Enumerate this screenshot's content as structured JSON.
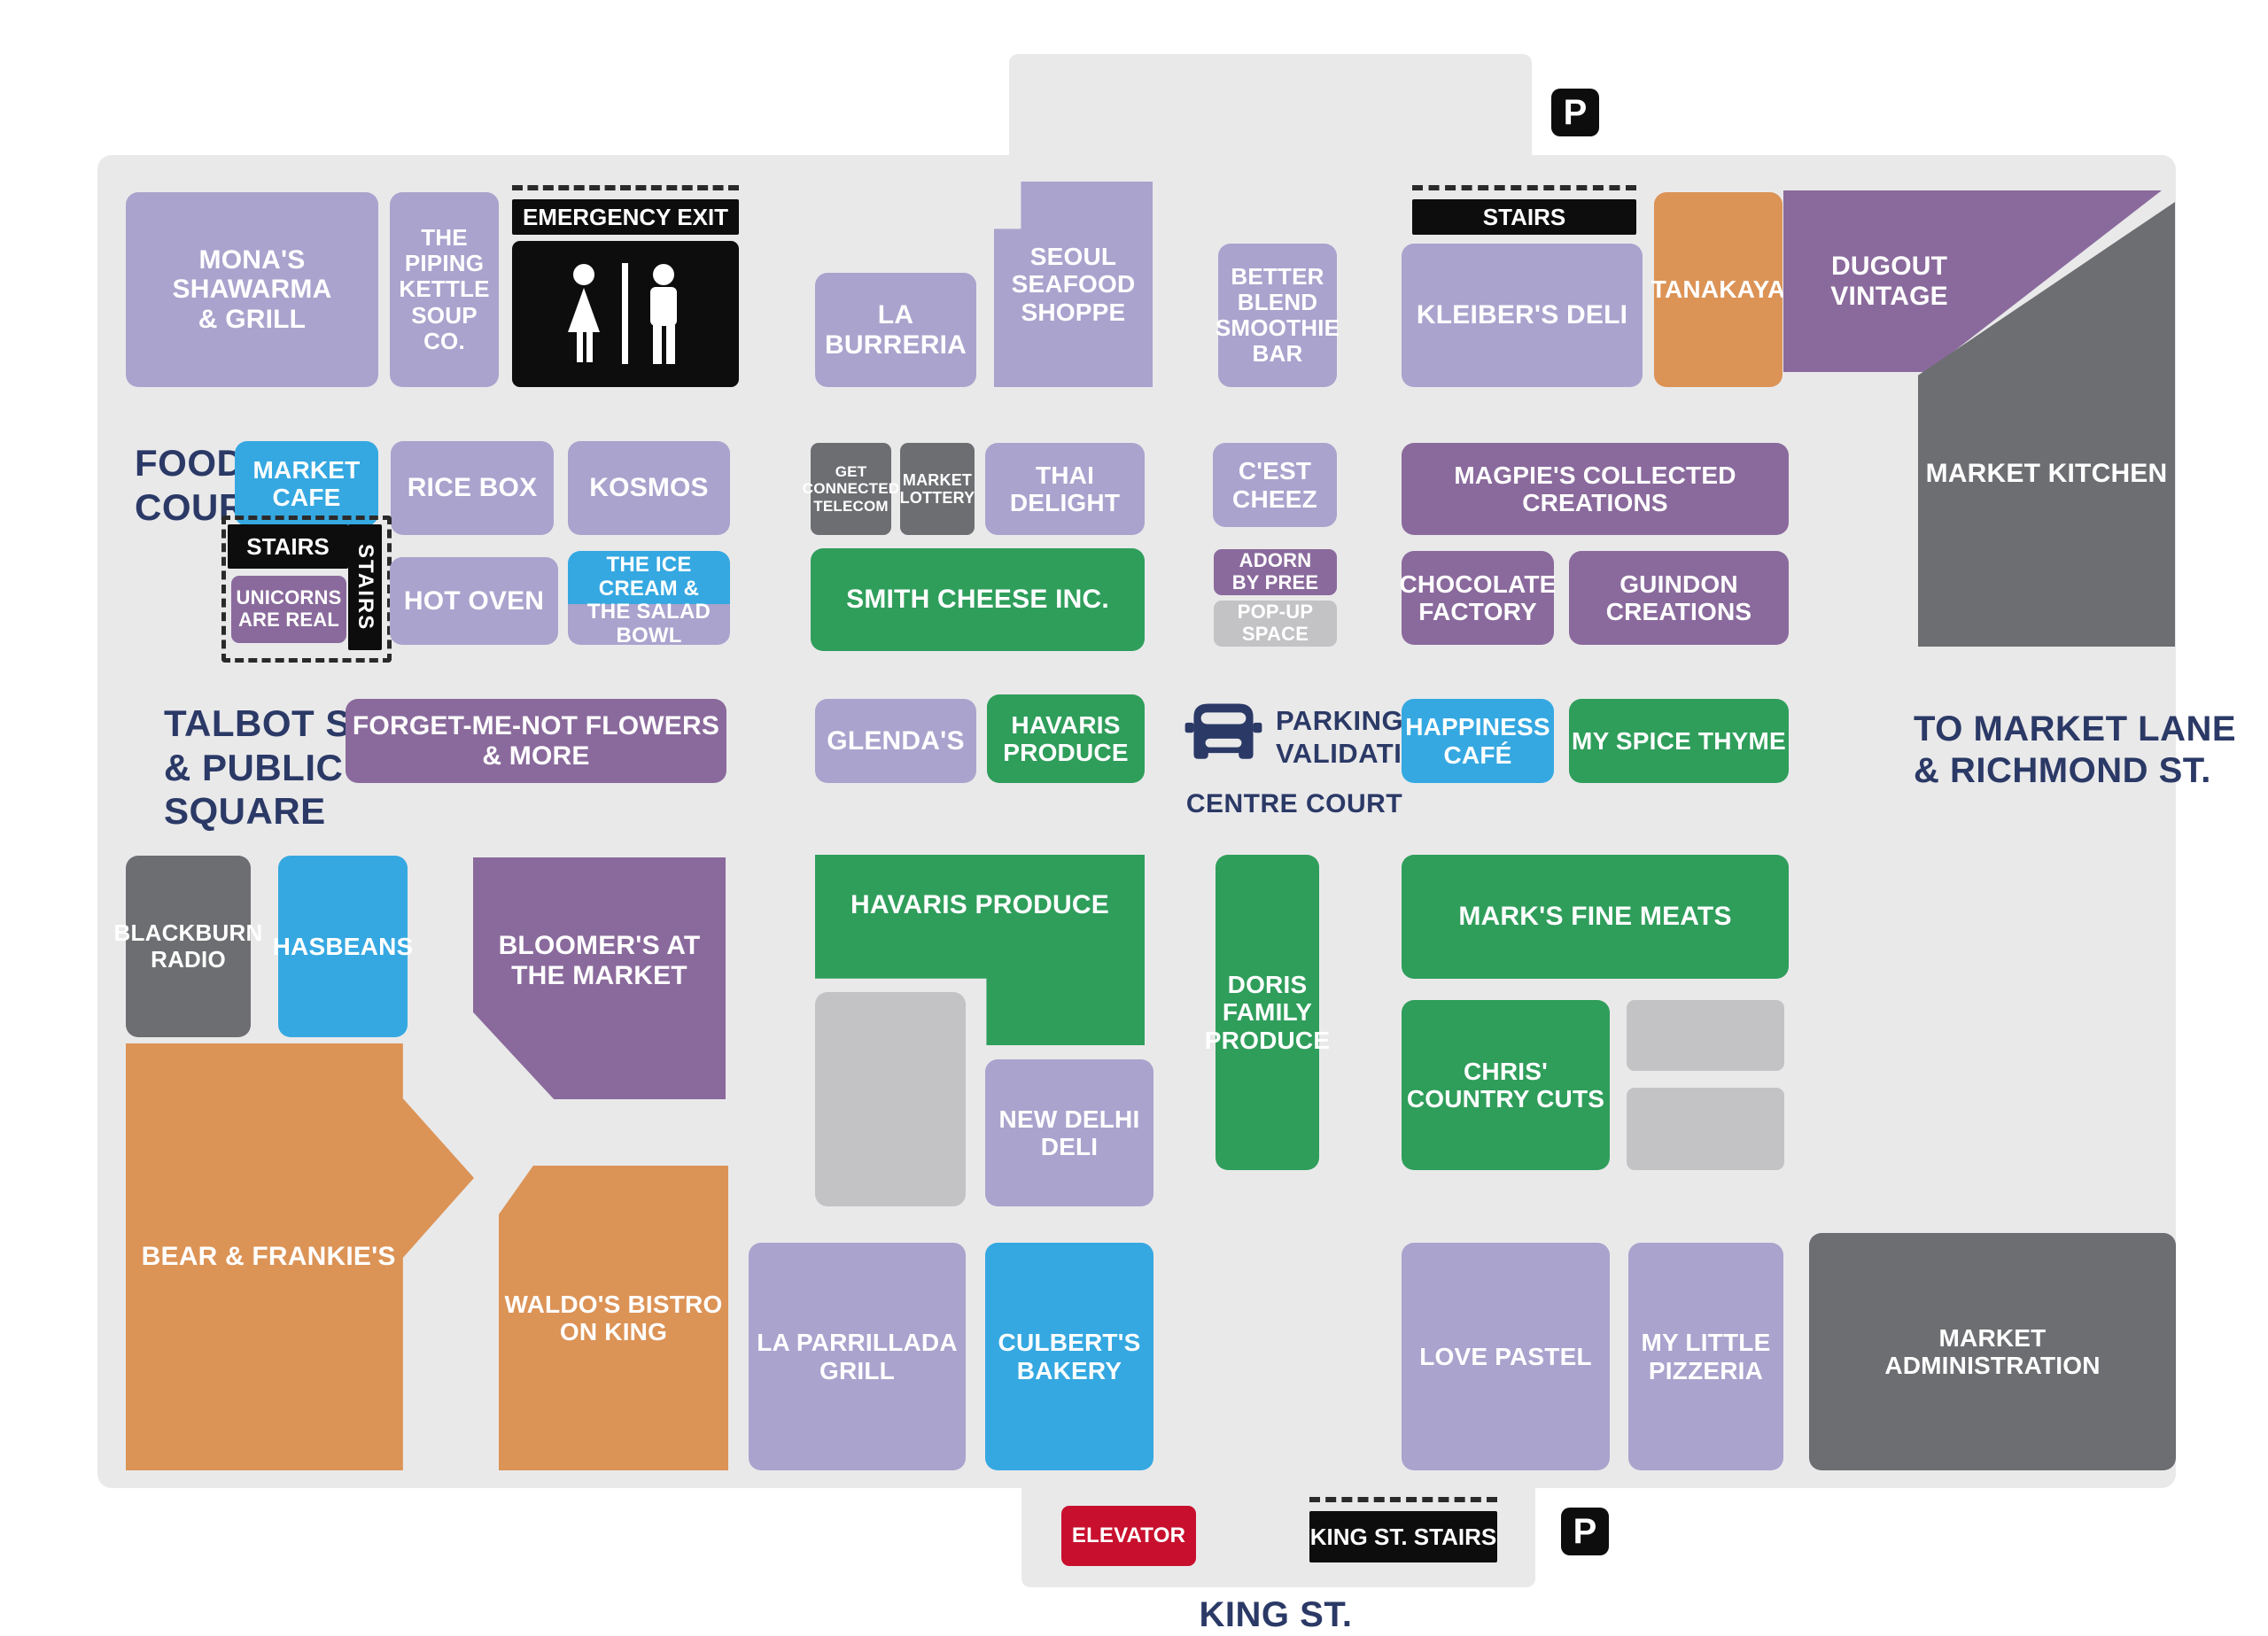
{
  "title": "Market floor plan",
  "palette": {
    "map_background": "#e9e9ea",
    "page_background": "#ffffff",
    "store_lavender": "#a9a3cd",
    "store_blue": "#35a8e1",
    "store_green": "#2f9e5b",
    "store_purple": "#8a6a9c",
    "store_orange": "#dc9356",
    "store_darkgray": "#6d6e71",
    "store_lightgray": "#c3c3c5",
    "banner_black": "#0d0d0d",
    "elevator_red": "#c8102e",
    "label_navy": "#2b3966"
  },
  "area_labels": {
    "food_court": "FOOD\nCOURT",
    "talbot": "TALBOT ST.\n& PUBLIC\nSQUARE",
    "to_market_lane": "TO MARKET LANE\n& RICHMOND ST.",
    "centre_court": "CENTRE COURT",
    "king_st": "KING ST."
  },
  "nav": {
    "emergency_exit": "EMERGENCY EXIT",
    "stairs_top_right": "STAIRS",
    "stairs_food_court_h": "STAIRS",
    "stairs_food_court_v": "STAIRS",
    "king_st_stairs": "KING ST. STAIRS",
    "elevator": "ELEVATOR",
    "parking_letter_top": "P",
    "parking_letter_bottom": "P",
    "parking_validation": "PARKING\nVALIDATION"
  },
  "stores": {
    "monas": {
      "label": "MONA'S SHAWARMA\n& GRILL",
      "color": "lavender"
    },
    "piping": {
      "label": "THE\nPIPING\nKETTLE\nSOUP CO.",
      "color": "lavender"
    },
    "laburreria": {
      "label": "LA BURRERIA",
      "color": "lavender"
    },
    "seoul": {
      "label": "SEOUL\nSEAFOOD\nSHOPPE",
      "color": "lavender"
    },
    "betterblend": {
      "label": "BETTER\nBLEND\nSMOOTHIE\nBAR",
      "color": "lavender"
    },
    "kleibers": {
      "label": "KLEIBER'S DELI",
      "color": "lavender"
    },
    "tanakaya": {
      "label": "TANAKAYA",
      "color": "orange"
    },
    "dugout": {
      "label": "DUGOUT\nVINTAGE",
      "color": "purple"
    },
    "market_kitchen": {
      "label": "MARKET KITCHEN",
      "color": "darkgray"
    },
    "market_cafe": {
      "label": "MARKET\nCAFE",
      "color": "blue"
    },
    "ricebox": {
      "label": "RICE BOX",
      "color": "lavender"
    },
    "kosmos": {
      "label": "KOSMOS",
      "color": "lavender"
    },
    "get_connected": {
      "label": "GET\nCONNECTED\nTELECOM",
      "color": "darkgray"
    },
    "market_lottery": {
      "label": "MARKET\nLOTTERY",
      "color": "darkgray"
    },
    "thai_delight": {
      "label": "THAI DELIGHT",
      "color": "lavender"
    },
    "cest_cheez": {
      "label": "C'EST\nCHEEZ",
      "color": "lavender"
    },
    "magpies": {
      "label": "MAGPIE'S COLLECTED\nCREATIONS",
      "color": "purple"
    },
    "smith_cheese": {
      "label": "SMITH CHEESE INC.",
      "color": "green"
    },
    "adorn": {
      "label": "ADORN\nBY PREE",
      "color": "purple"
    },
    "popup": {
      "label": "POP-UP\nSPACE",
      "color": "lightgray"
    },
    "unicorns": {
      "label": "UNICORNS\nARE REAL",
      "color": "purple"
    },
    "hot_oven": {
      "label": "HOT OVEN",
      "color": "lavender"
    },
    "ice_cream": {
      "label": "THE ICE\nCREAM &",
      "color": "blue"
    },
    "salad_bowl": {
      "label": "THE SALAD BOWL",
      "color": "lavender"
    },
    "chocolate": {
      "label": "CHOCOLATE\nFACTORY",
      "color": "purple"
    },
    "guindon": {
      "label": "GUINDON\nCREATIONS",
      "color": "purple"
    },
    "forgetmenot": {
      "label": "FORGET-ME-NOT FLOWERS & MORE",
      "color": "purple"
    },
    "glendas": {
      "label": "GLENDA'S",
      "color": "lavender"
    },
    "havaris_small": {
      "label": "HAVARIS\nPRODUCE",
      "color": "green"
    },
    "happiness": {
      "label": "HAPPINESS\nCAFÉ",
      "color": "blue"
    },
    "myspice": {
      "label": "MY SPICE THYME",
      "color": "green"
    },
    "blackburn": {
      "label": "BLACKBURN\nRADIO",
      "color": "darkgray"
    },
    "hasbeans": {
      "label": "HASBEANS",
      "color": "blue"
    },
    "bloomers": {
      "label": "BLOOMER'S AT\nTHE MARKET",
      "color": "purple"
    },
    "havaris_big": {
      "label": "HAVARIS PRODUCE",
      "color": "green"
    },
    "vacant_1": {
      "label": "",
      "color": "lightgray"
    },
    "new_delhi": {
      "label": "NEW DELHI\nDELI",
      "color": "lavender"
    },
    "doris": {
      "label": "DORIS\nFAMILY\nPRODUCE",
      "color": "green"
    },
    "marks": {
      "label": "MARK'S FINE MEATS",
      "color": "green"
    },
    "chris": {
      "label": "CHRIS'\nCOUNTRY CUTS",
      "color": "green"
    },
    "vacant_2": {
      "label": "",
      "color": "lightgray"
    },
    "vacant_3": {
      "label": "",
      "color": "lightgray"
    },
    "bear": {
      "label": "BEAR & FRANKIE'S",
      "color": "orange"
    },
    "waldos": {
      "label": "WALDO'S BISTRO\nON KING",
      "color": "orange"
    },
    "parrillada": {
      "label": "LA PARRILLADA\nGRILL",
      "color": "lavender"
    },
    "culberts": {
      "label": "CULBERT'S\nBAKERY",
      "color": "blue"
    },
    "love_pastel": {
      "label": "LOVE PASTEL",
      "color": "lavender"
    },
    "pizzeria": {
      "label": "MY LITTLE\nPIZZERIA",
      "color": "lavender"
    },
    "market_admin": {
      "label": "MARKET\nADMINISTRATION",
      "color": "darkgray"
    }
  }
}
